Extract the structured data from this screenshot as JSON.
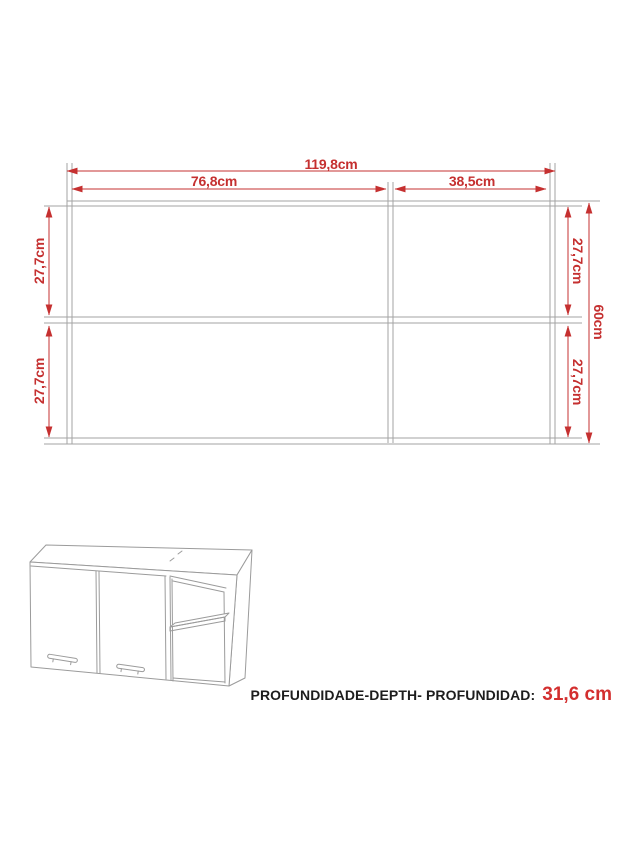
{
  "front_view": {
    "dim_total_width": "119,8cm",
    "dim_left_width": "76,8cm",
    "dim_right_width": "38,5cm",
    "dim_left_top_height": "27,7cm",
    "dim_left_bottom_height": "27,7cm",
    "dim_right_top_height": "27,7cm",
    "dim_right_bottom_height": "27,7cm",
    "dim_total_height": "60cm"
  },
  "depth_note": {
    "label": "PROFUNDIDADE-DEPTH- PROFUNDIDAD:",
    "value": "31,6 cm"
  },
  "colors": {
    "dimension_red": "#c53030",
    "depth_value_red": "#d32f2f",
    "drawing_gray": "#a3a3a3",
    "iso_gray": "#9b9b9b"
  }
}
